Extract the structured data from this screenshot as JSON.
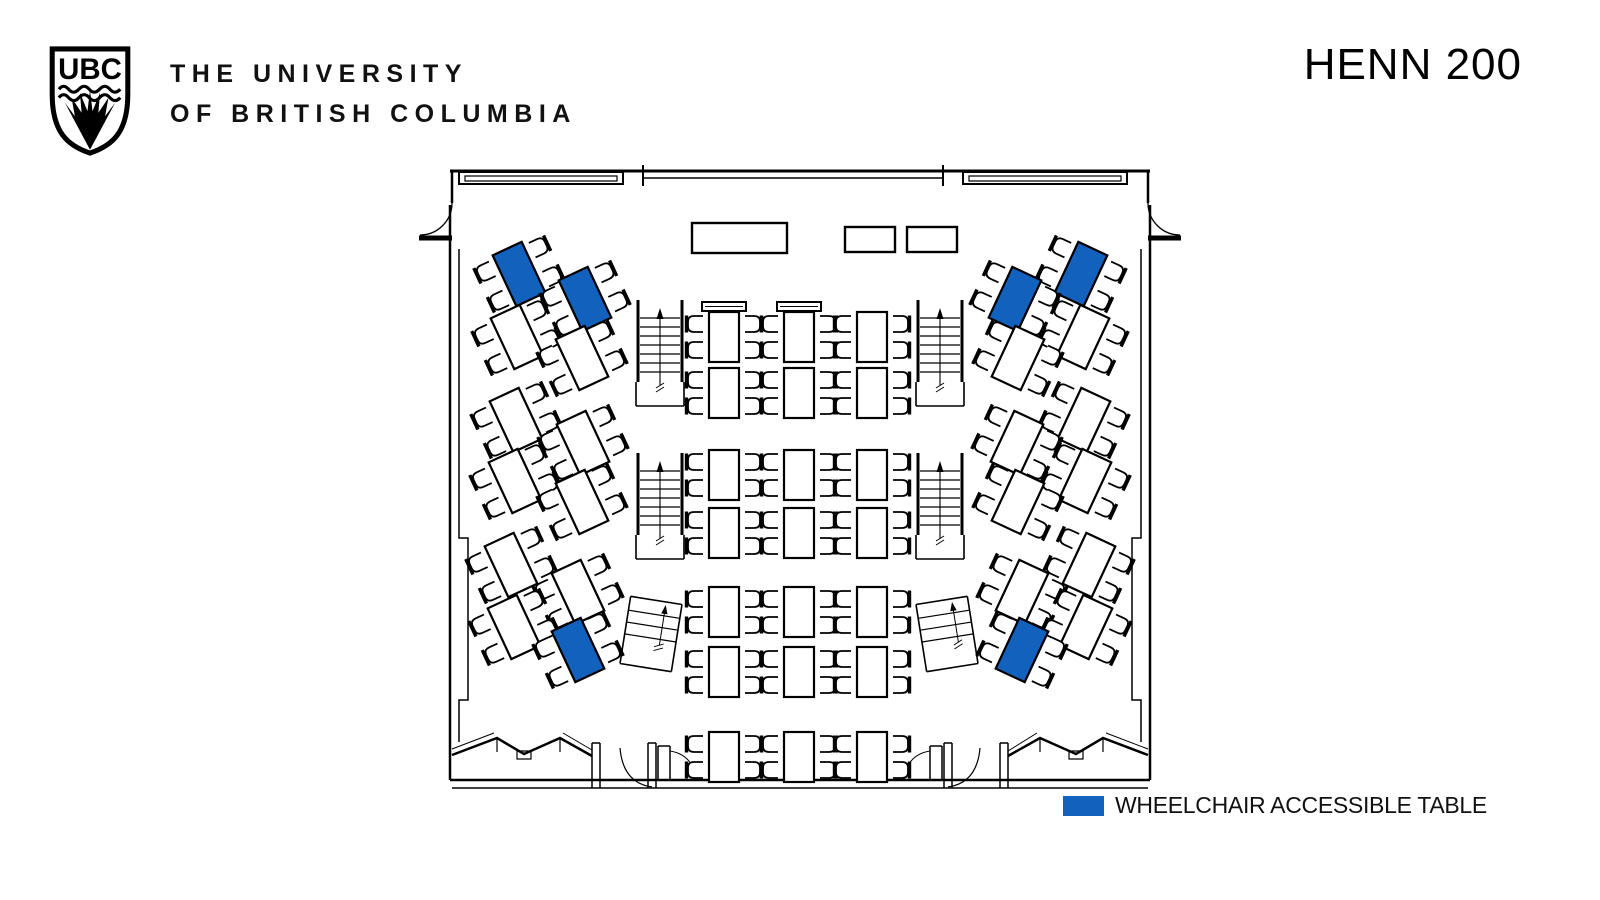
{
  "header": {
    "logo_acronym": "UBC",
    "wordmark_line1": "THE UNIVERSITY",
    "wordmark_line2": "OF BRITISH COLUMBIA",
    "room_title": "HENN 200"
  },
  "legend": {
    "label": "WHEELCHAIR ACCESSIBLE TABLE",
    "swatch_color": "#1261BD"
  },
  "plan": {
    "colors": {
      "line": "#000000",
      "accessible": "#1261BD",
      "table_fill": "#ffffff"
    },
    "walls": [
      {
        "d": "M450,171 H1150",
        "w": 3
      },
      {
        "d": "M459,172 h164 v12 h-164 Z",
        "w": 2
      },
      {
        "d": "M465,176 h152 v5 h-152 Z",
        "w": 1.2
      },
      {
        "d": "M963,172 h164 v12 h-164 Z",
        "w": 2
      },
      {
        "d": "M969,176 h152 v5 h-152 Z",
        "w": 1.2
      },
      {
        "d": "M643,178 H943",
        "w": 1.5
      },
      {
        "d": "M643,165 V186 M943,165 V186",
        "w": 2
      },
      {
        "d": "M452,171 V203",
        "w": 2.5
      },
      {
        "d": "M1148,171 V203",
        "w": 2.5
      },
      {
        "d": "M452,203 A32,32 0 0 1 420,235",
        "w": 1.3
      },
      {
        "d": "M419,238 H452",
        "w": 5
      },
      {
        "d": "M1148,203 A32,32 0 0 0 1180,235",
        "w": 1.3
      },
      {
        "d": "M1148,238 H1181",
        "w": 5
      },
      {
        "d": "M450,205 V780",
        "w": 2.5
      },
      {
        "d": "M459,249 V538 H468 V700 H459 V742",
        "w": 1.5
      },
      {
        "d": "M1150,205 V780",
        "w": 2.5
      },
      {
        "d": "M1141,249 V538 H1132 V700 H1141 V742",
        "w": 1.5
      },
      {
        "d": "M450,780 H1150",
        "w": 2.5
      },
      {
        "d": "M452,788 H1148",
        "w": 1.5
      },
      {
        "d": "M452,755 L497,738 L524,754 L560,738 L592,756",
        "w": 2.5
      },
      {
        "d": "M497,738 V752 M560,738 V752",
        "w": 1.2
      },
      {
        "d": "M517,751 h14 v8 h-14 Z",
        "w": 1.2
      },
      {
        "d": "M452,749 L494,733",
        "w": 1
      },
      {
        "d": "M563,733 L592,750",
        "w": 1
      },
      {
        "d": "M1008,756 L1040,738 L1076,754 L1103,738 L1148,755",
        "w": 2.5
      },
      {
        "d": "M1040,738 V752 M1103,738 V752",
        "w": 1.2
      },
      {
        "d": "M1069,751 h14 v8 h-14 Z",
        "w": 1.2
      },
      {
        "d": "M1106,733 L1148,749",
        "w": 1
      },
      {
        "d": "M1008,751 L1037,733",
        "w": 1
      },
      {
        "d": "M592,743 V788 M600,743 V788 M592,743 H600",
        "w": 1.5
      },
      {
        "d": "M648,743 V788 M656,743 V788 M648,743 H656",
        "w": 1.5
      },
      {
        "d": "M620,748 Q623,783 652,787",
        "w": 1.2
      },
      {
        "d": "M944,743 V788 M952,743 V788 M944,743 H952",
        "w": 1.5
      },
      {
        "d": "M1000,743 V788 M1008,743 V788 M1000,743 H1008",
        "w": 1.5
      },
      {
        "d": "M980,748 Q977,783 948,787",
        "w": 1.2
      },
      {
        "d": "M658,746 V780 M670,746 V780 M658,746 H670",
        "w": 1.5
      },
      {
        "d": "M930,746 V780 M942,746 V780 M930,746 H942",
        "w": 1.5
      },
      {
        "d": "M670,751 Q694,755 696,781",
        "w": 1
      },
      {
        "d": "M930,751 Q906,755 904,781",
        "w": 1
      }
    ],
    "stairs": [
      [
        637,
        300
      ],
      [
        917,
        300
      ],
      [
        637,
        453
      ],
      [
        917,
        453
      ]
    ],
    "mini_stairs": [
      [
        651,
        634,
        9
      ],
      [
        947,
        634,
        -9
      ]
    ],
    "privacy_screens": [
      [
        702,
        302
      ],
      [
        777,
        302
      ]
    ],
    "lectern": [
      692,
      223,
      95,
      30
    ],
    "av_boxes": [
      [
        845,
        227,
        50,
        25
      ],
      [
        907,
        227,
        50,
        25
      ]
    ],
    "center_tables": {
      "w": 30,
      "h": 50,
      "cols": [
        724,
        799,
        872
      ],
      "rows": [
        312,
        368,
        450,
        508,
        587,
        647,
        732
      ]
    },
    "wing_tables": {
      "w": 32,
      "h": 56,
      "left": {
        "rot": -25,
        "tables": [
          [
            519,
            274,
            1
          ],
          [
            585,
            299,
            1
          ],
          [
            517,
            337,
            0
          ],
          [
            582,
            358,
            0
          ],
          [
            516,
            420,
            0
          ],
          [
            583,
            443,
            0
          ],
          [
            515,
            481,
            0
          ],
          [
            582,
            502,
            0
          ],
          [
            511,
            565,
            0
          ],
          [
            578,
            592,
            0
          ],
          [
            514,
            627,
            0
          ],
          [
            578,
            650,
            1
          ]
        ]
      },
      "right": {
        "rot": 25,
        "tables": [
          [
            1081,
            274,
            1
          ],
          [
            1015,
            299,
            1
          ],
          [
            1083,
            337,
            0
          ],
          [
            1018,
            358,
            0
          ],
          [
            1084,
            420,
            0
          ],
          [
            1017,
            443,
            0
          ],
          [
            1085,
            481,
            0
          ],
          [
            1018,
            502,
            0
          ],
          [
            1089,
            565,
            0
          ],
          [
            1022,
            592,
            0
          ],
          [
            1086,
            627,
            0
          ],
          [
            1022,
            650,
            1
          ]
        ]
      }
    }
  }
}
